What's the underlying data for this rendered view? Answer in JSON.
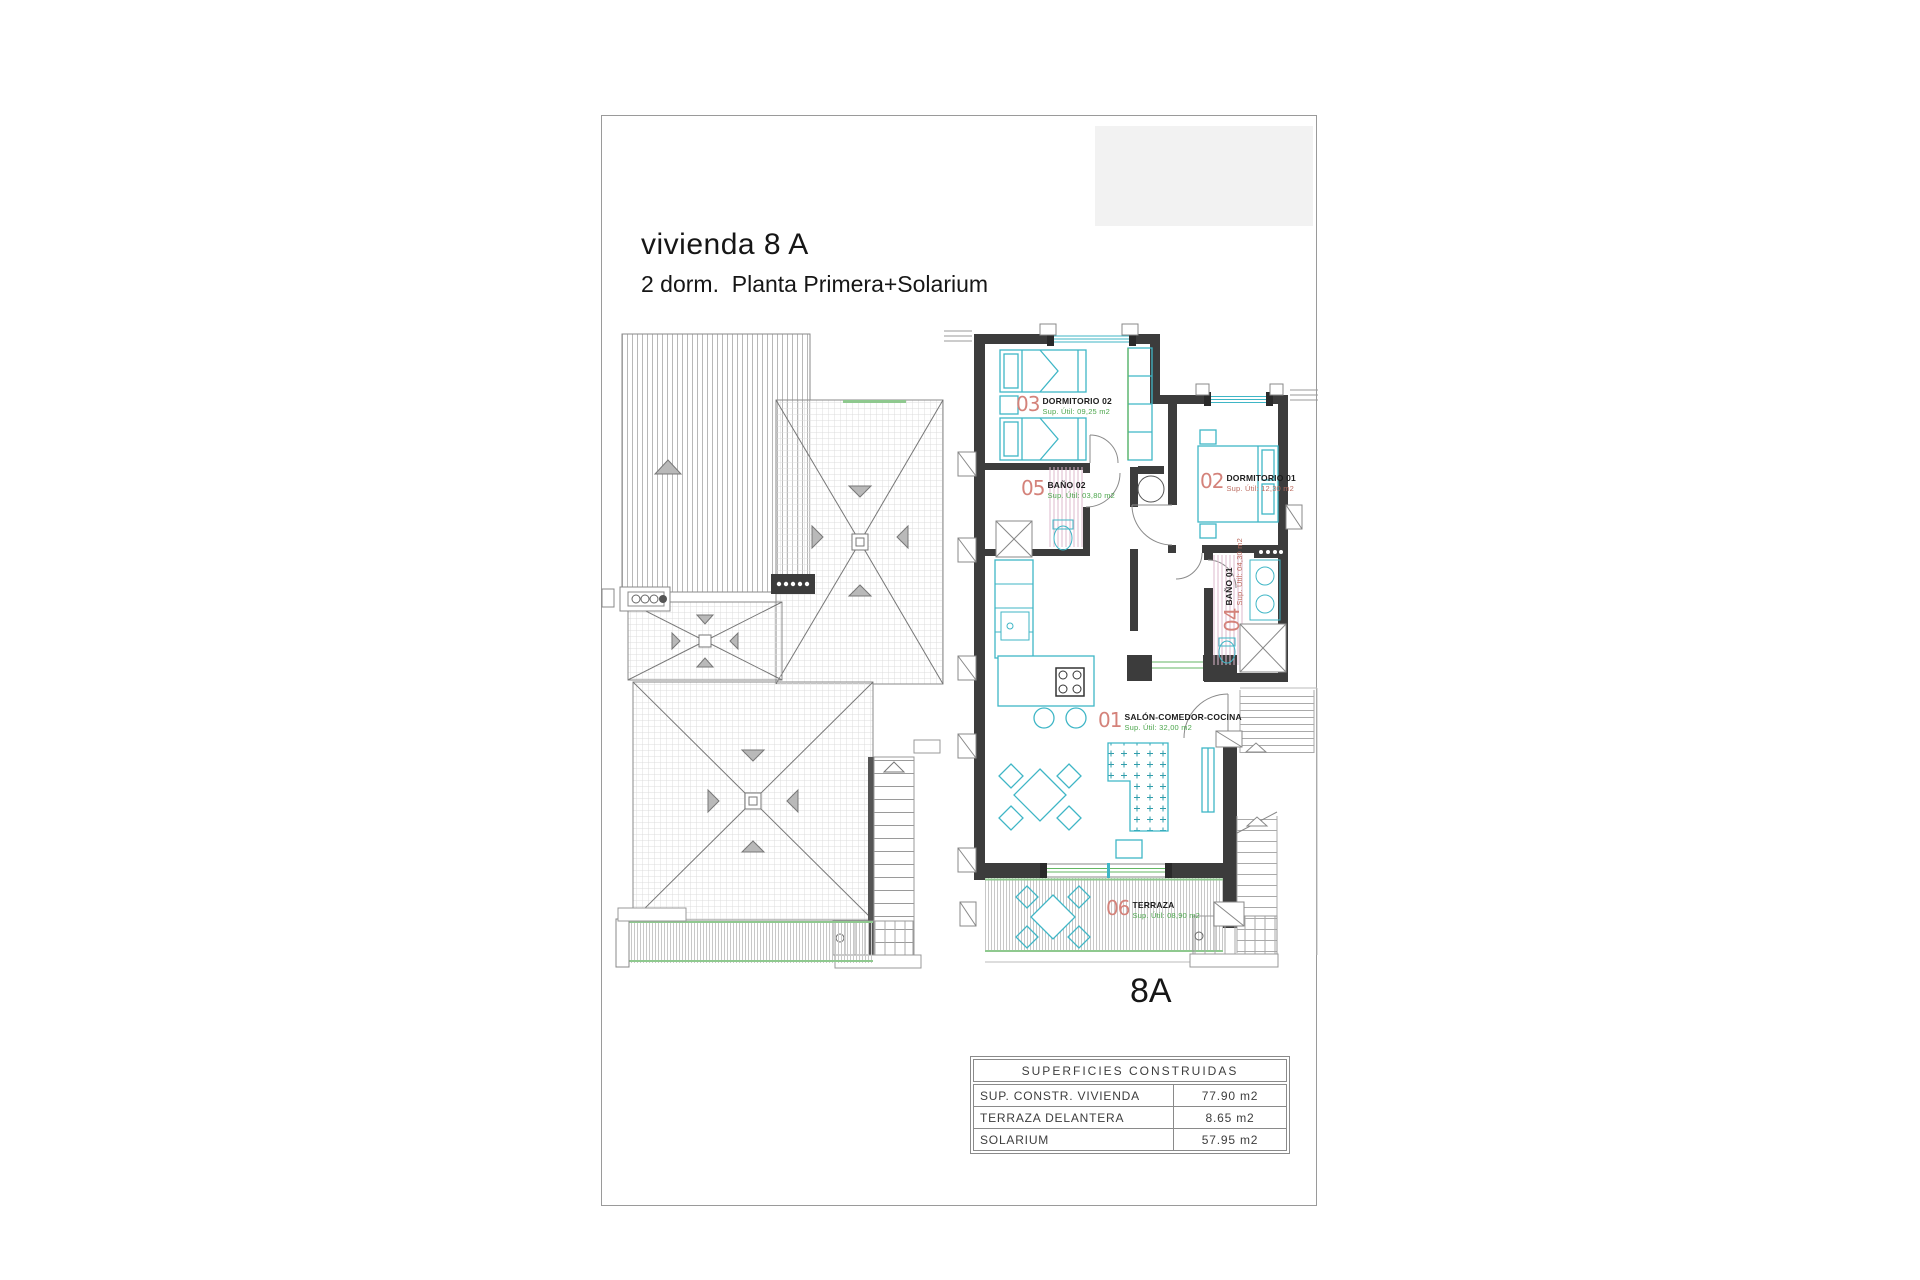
{
  "page": {
    "title": "vivienda 8 A",
    "subtitle": "2 dorm.  Planta Primera+Solarium",
    "plan_label": "8A"
  },
  "rooms": [
    {
      "number": "01",
      "name": "SALÓN-COMEDOR-COCINA",
      "area": "Sup. Útil: 32,00 m2"
    },
    {
      "number": "02",
      "name": "DORMITORIO 01",
      "area": "Sup. Útil: 12,30 m2"
    },
    {
      "number": "03",
      "name": "DORMITORIO 02",
      "area": "Sup. Útil: 09,25 m2"
    },
    {
      "number": "04",
      "name": "BAÑO 01",
      "area": "Sup. Útil: 04,30 m2"
    },
    {
      "number": "05",
      "name": "BAÑO 02",
      "area": "Sup. Útil: 03,80 m2"
    },
    {
      "number": "06",
      "name": "TERRAZA",
      "area": "Sup. Útil: 08,90 m2"
    }
  ],
  "areas_table": {
    "header": "SUPERFICIES CONSTRUIDAS",
    "rows": [
      {
        "label": "SUP. CONSTR. VIVIENDA",
        "value": "77.90 m2"
      },
      {
        "label": "TERRAZA DELANTERA",
        "value": "8.65 m2"
      },
      {
        "label": "SOLARIUM",
        "value": "57.95 m2"
      }
    ]
  },
  "colors": {
    "wall": "#3c3c3c",
    "furniture": "#3fb6c6",
    "green_accent": "#63b663",
    "room_number": "#d4827a",
    "line_gray": "#8a8a8a",
    "bath_hatch": "#dcb8cc"
  }
}
